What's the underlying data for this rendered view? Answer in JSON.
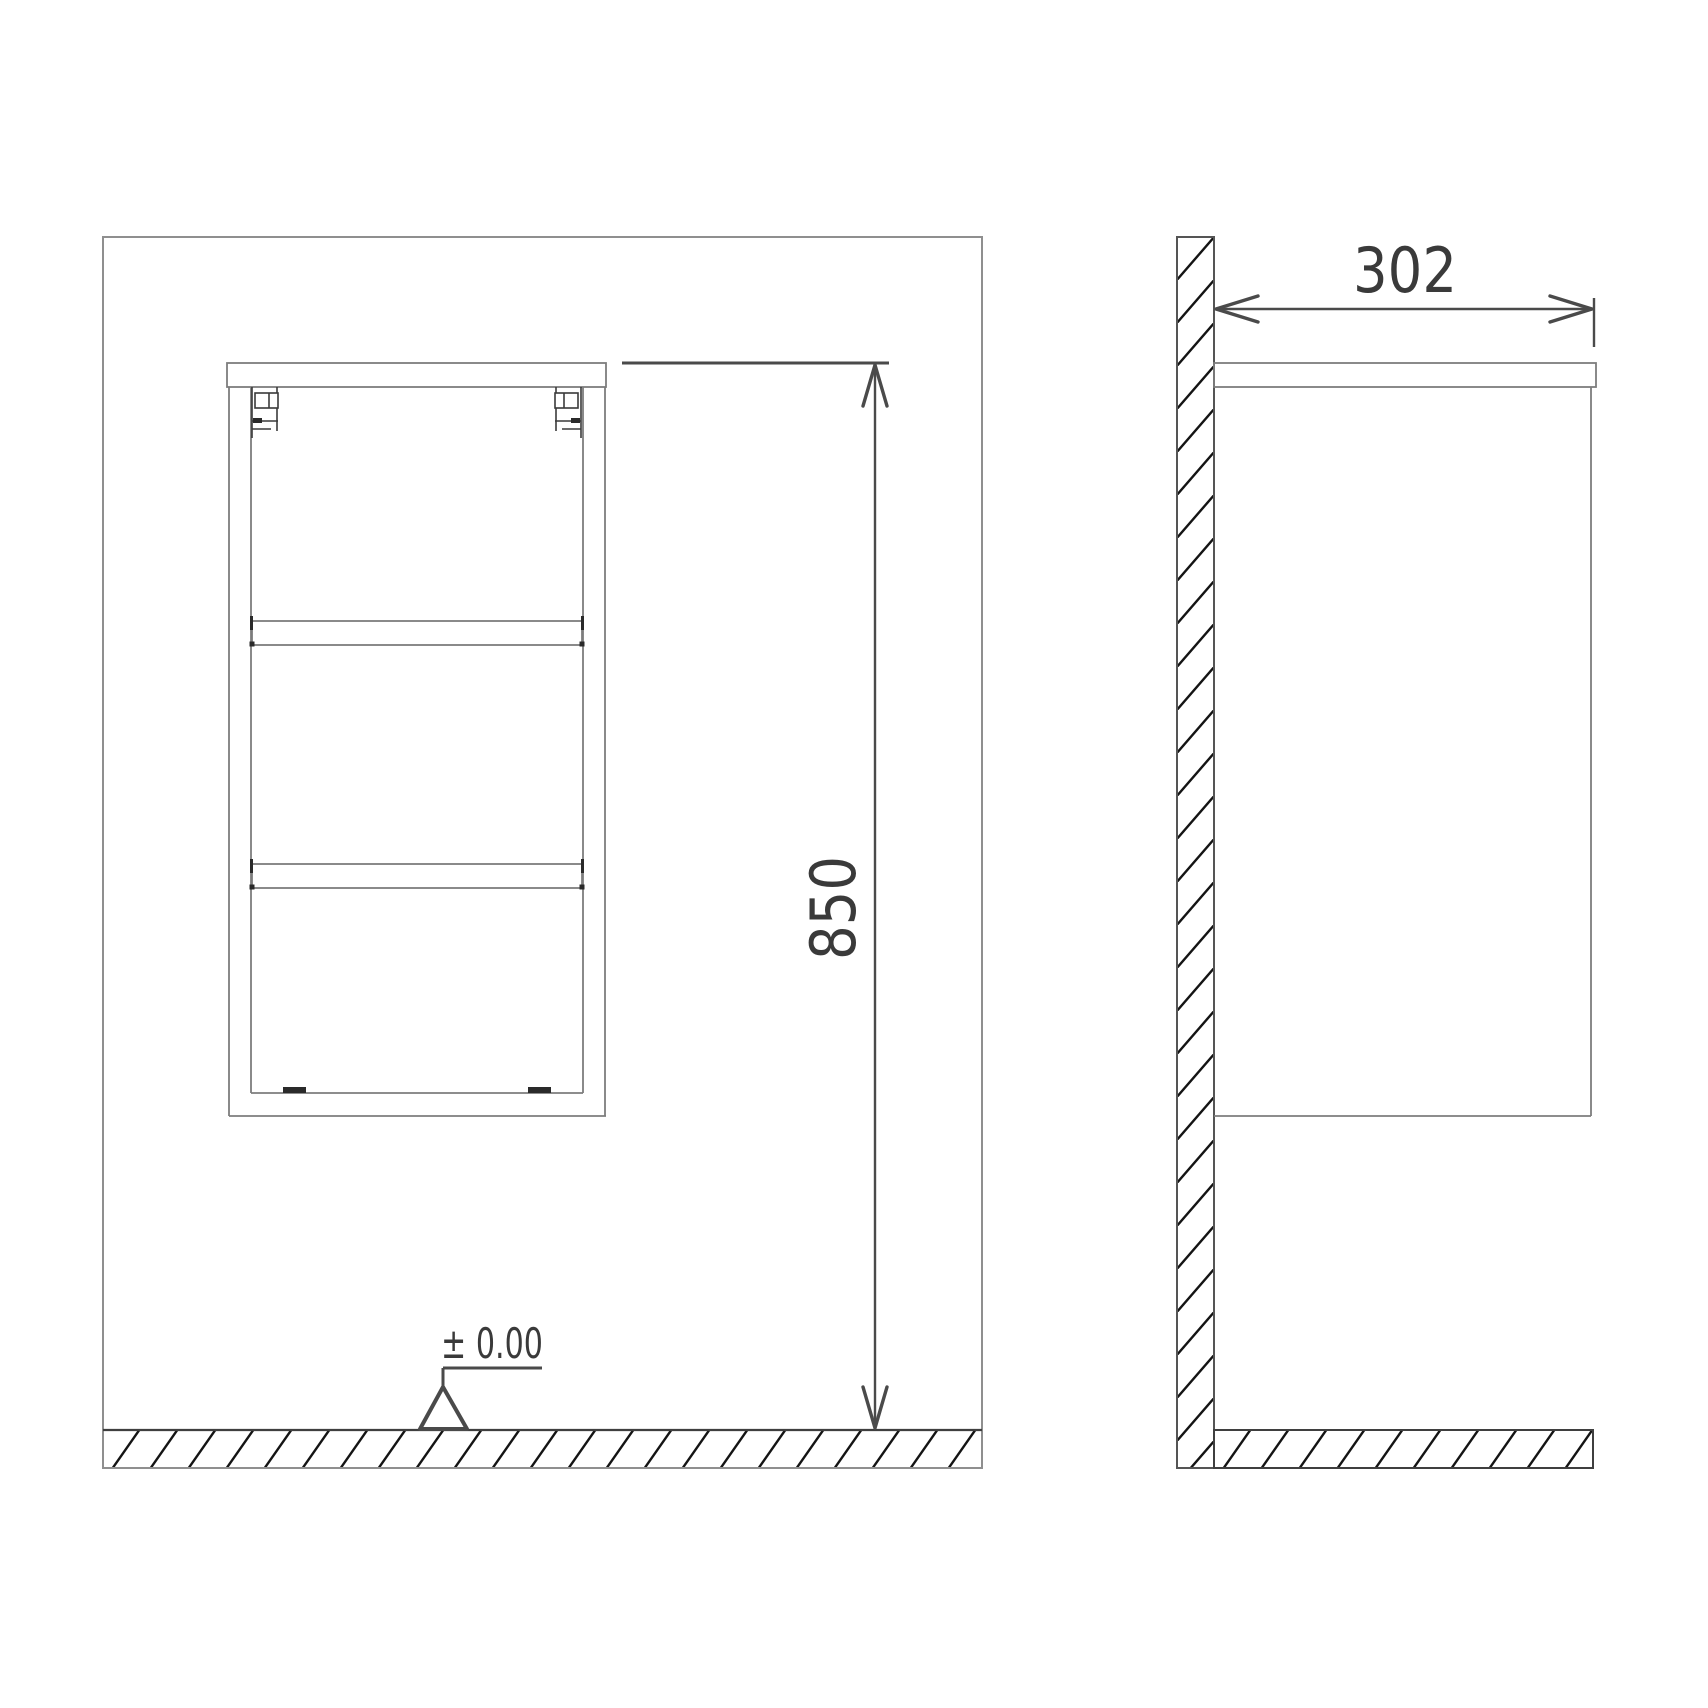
{
  "drawing": {
    "views": {
      "front_elevation": {
        "name": "front-elevation-with-wall"
      },
      "side_section": {
        "name": "side-view-with-wall-section"
      }
    },
    "dimensions": {
      "mounting_height": {
        "label": "850"
      },
      "depth": {
        "label": "302"
      }
    },
    "datum": {
      "label": "± 0.00"
    },
    "colors": {
      "background": "#ffffff",
      "room_outline": "#8f8f8f",
      "cabinet_line": "#7d7d7d",
      "detail_line": "#3a3a3a",
      "dimension_line": "#4a4a4a",
      "hatch_line": "#141414",
      "text": "#3a3a3a"
    }
  }
}
